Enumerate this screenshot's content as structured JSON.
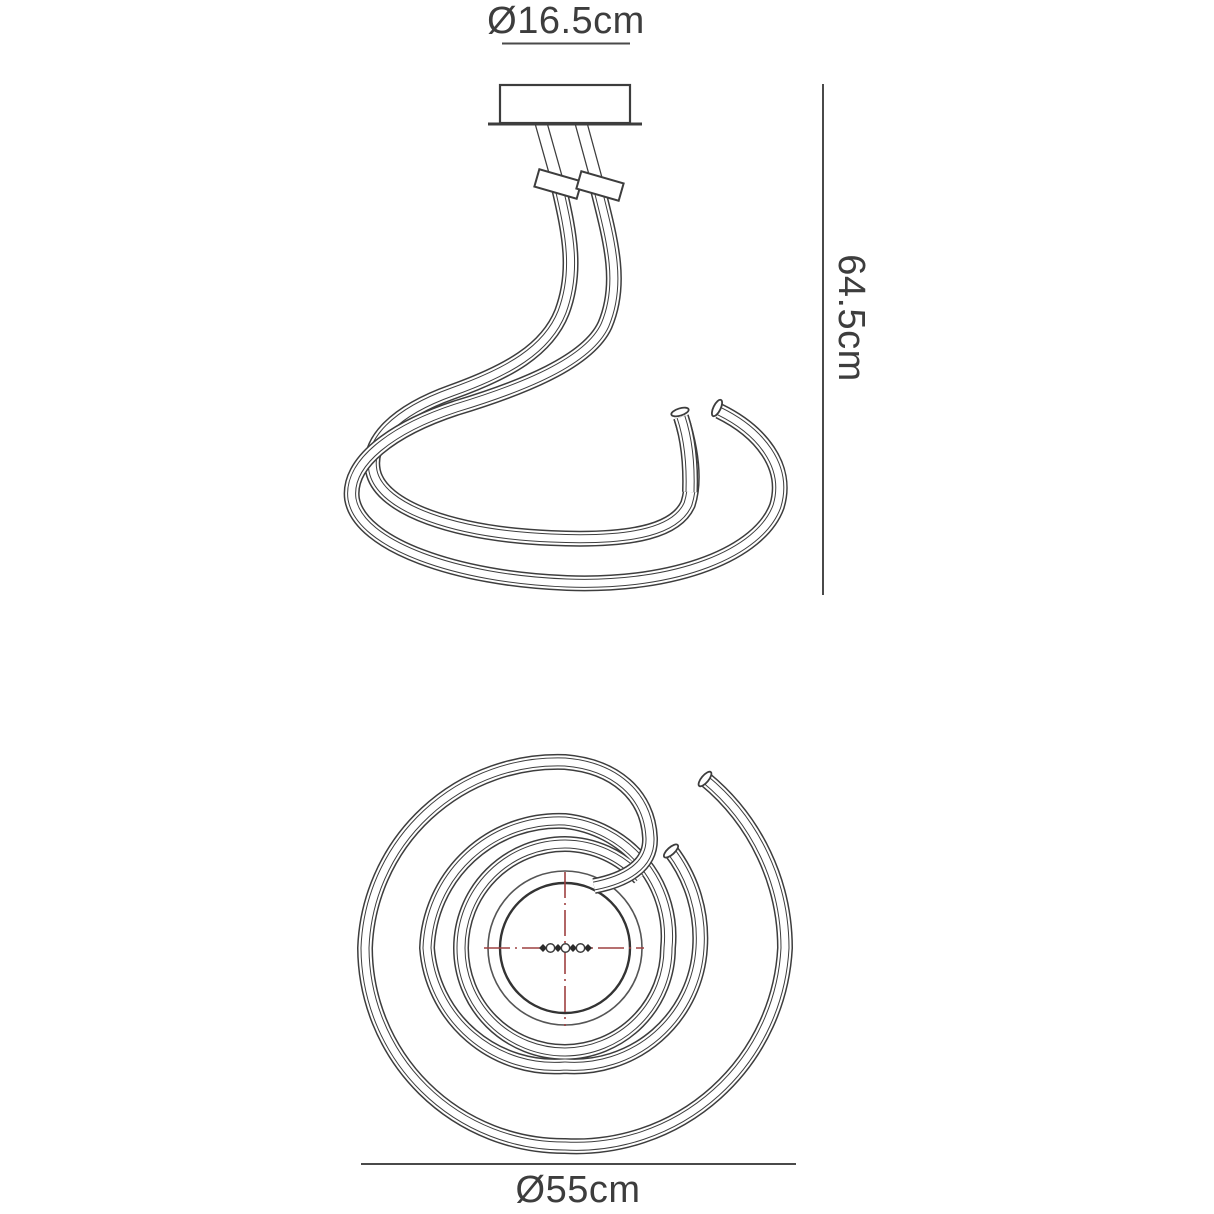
{
  "drawing": {
    "background": "#ffffff",
    "line_color": "#3d3d3d",
    "centerline_color": "#9e4040"
  },
  "dimensions": {
    "canopy_diameter": "Ø16.5cm",
    "fixture_height": "64.5cm",
    "fixture_diameter": "Ø55cm"
  }
}
